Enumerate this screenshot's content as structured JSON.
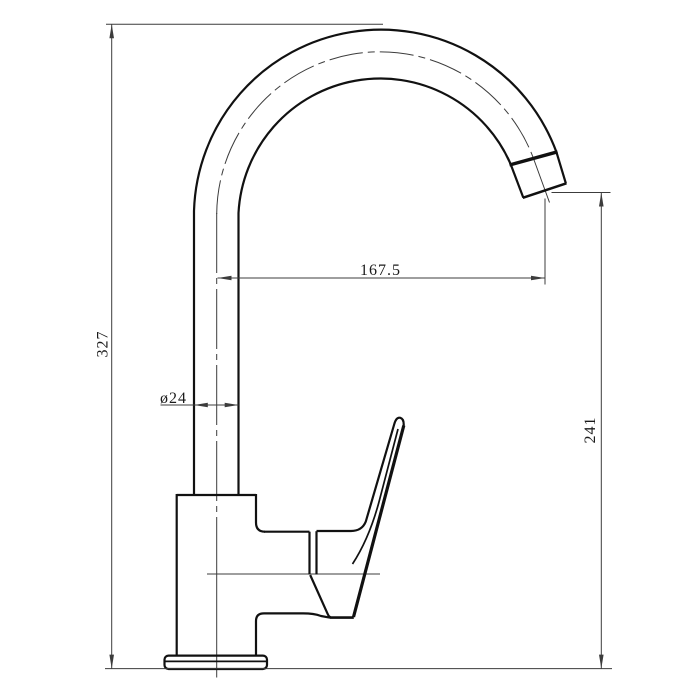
{
  "drawing": {
    "labels": {
      "overall_height": "327",
      "spout_reach": "167.5",
      "pipe_diameter": "ø24",
      "outlet_height": "241"
    },
    "colors": {
      "background": "#ffffff",
      "object_line": "#111111",
      "thin_line": "#3c3c3c",
      "text": "#1a1a1a"
    }
  }
}
